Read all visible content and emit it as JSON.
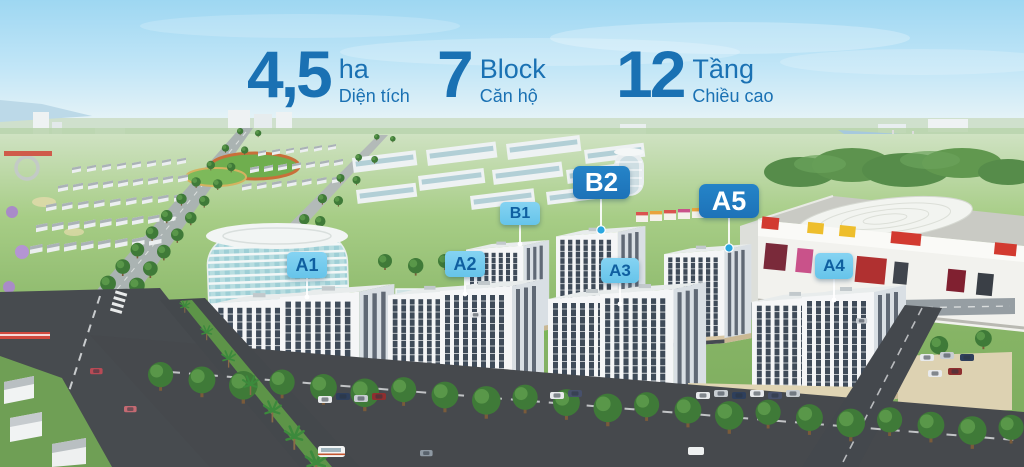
{
  "stats": {
    "items": [
      {
        "value": "4,5",
        "unit": "ha",
        "label": "Diện tích"
      },
      {
        "value": "7",
        "unit": "Block",
        "label": "Căn hộ"
      },
      {
        "value": "12",
        "unit": "Tầng",
        "label": "Chiều cao"
      }
    ]
  },
  "building_labels": {
    "a1": "A1",
    "a2": "A2",
    "a3": "A3",
    "a4": "A4",
    "a5": "A5",
    "b1": "B1",
    "b2": "B2"
  },
  "colors": {
    "stat_text": "#1a71b3",
    "badge_dark_bg": "#1d72b8",
    "badge_dark_text": "#ffffff",
    "badge_light_bg": "#85d3f2",
    "badge_light_text": "#0f5fa0",
    "marker_dot": "#2ba7e0"
  }
}
